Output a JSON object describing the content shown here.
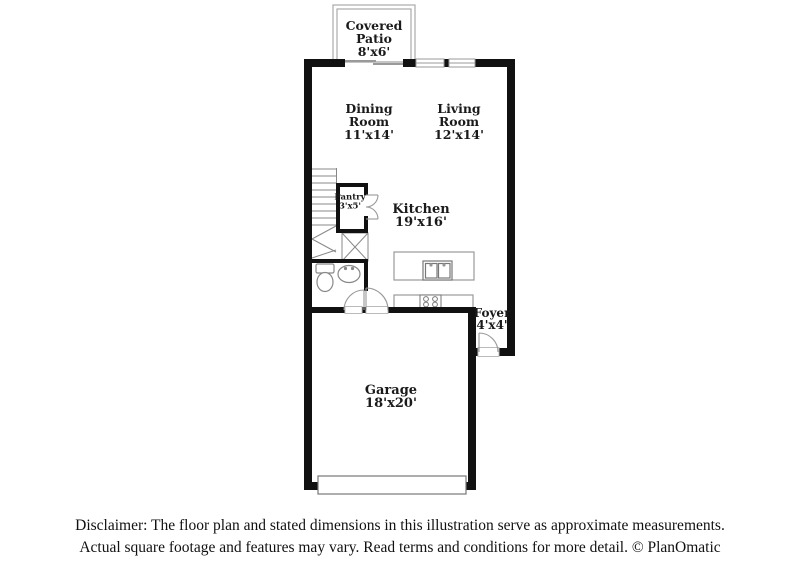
{
  "floor_plan": {
    "title": "Floor plan",
    "rooms": {
      "covered_patio": {
        "name": "Covered Patio",
        "dims": "8'x6'"
      },
      "dining_room": {
        "name": "Dining Room",
        "dims": "11'x14'"
      },
      "living_room": {
        "name": "Living Room",
        "dims": "12'x14'"
      },
      "pantry": {
        "name": "Pantry",
        "dims": "3'x5'"
      },
      "kitchen": {
        "name": "Kitchen",
        "dims": "19'x16'"
      },
      "foyer": {
        "name": "Foyer",
        "dims": "4'x4'"
      },
      "garage": {
        "name": "Garage",
        "dims": "18'x20'"
      }
    },
    "colors": {
      "wall": "#111111",
      "thin_line": "#999999",
      "text": "#1a1a1a",
      "background": "#ffffff"
    }
  },
  "disclaimer": {
    "line1": "Disclaimer: The floor plan and stated dimensions in this illustration serve as approximate measurements.",
    "line2": "Actual square footage and features may vary. Read terms and conditions for more detail. © PlanOmatic"
  }
}
